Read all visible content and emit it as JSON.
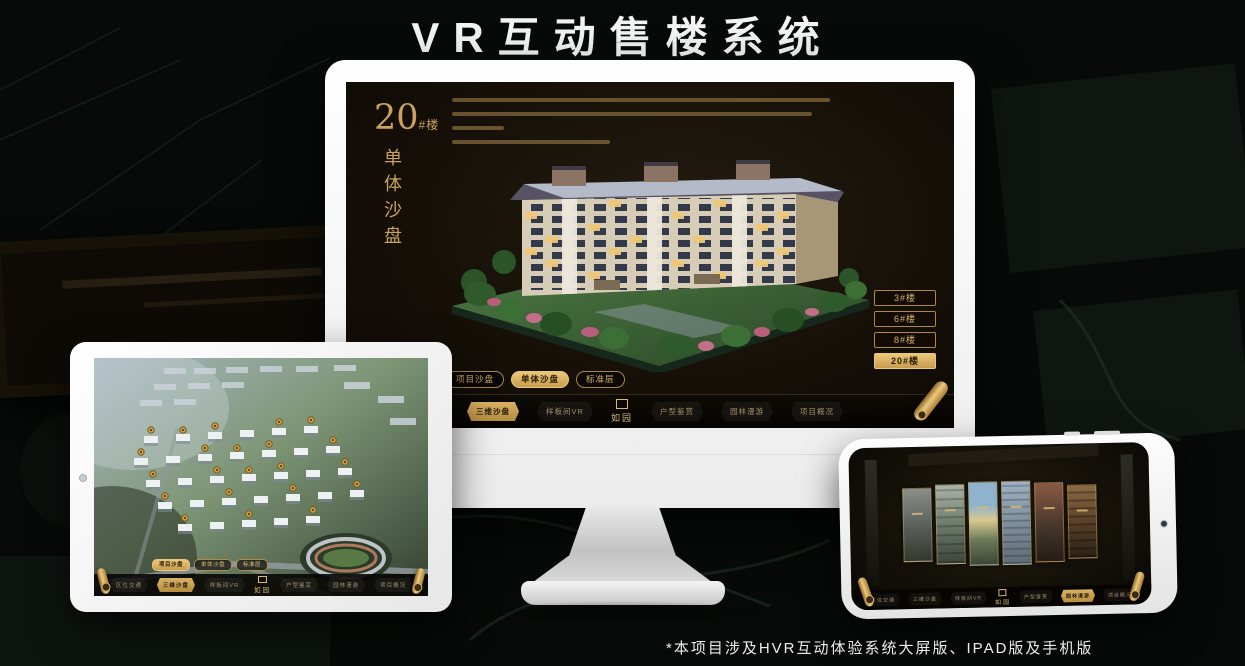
{
  "page": {
    "title": "VR互动售楼系统",
    "footnote": "*本项目涉及HVR互动体验系统大屏版、IPAD版及手机版"
  },
  "colors": {
    "gold": "#c9a25e",
    "gold_bright": "#ecc979",
    "app_bg": "#150f08",
    "nav_bg": "#0a0805"
  },
  "app_nav": {
    "logo": "如园",
    "items": [
      {
        "label": "区位交通"
      },
      {
        "label": "三维沙盘"
      },
      {
        "label": "样板间VR"
      },
      {
        "label": "户型鉴赏"
      },
      {
        "label": "园林漫游"
      },
      {
        "label": "项目概况"
      }
    ],
    "monitor_active": "三维沙盘",
    "phone_active": "园林漫游"
  },
  "view_tabs": {
    "items": [
      {
        "label": "项目沙盘"
      },
      {
        "label": "单体沙盘"
      },
      {
        "label": "标准层"
      }
    ],
    "monitor_active": "单体沙盘",
    "tablet_active": "项目沙盘"
  },
  "monitor": {
    "block_num": "20",
    "block_suffix": "#楼",
    "block_sub": "单体沙盘",
    "floor_buttons": [
      {
        "label": "3#楼",
        "active": false
      },
      {
        "label": "6#楼",
        "active": false
      },
      {
        "label": "8#楼",
        "active": false
      },
      {
        "label": "20#楼",
        "active": true
      }
    ]
  },
  "phone": {
    "gallery_panel_count": 6
  }
}
